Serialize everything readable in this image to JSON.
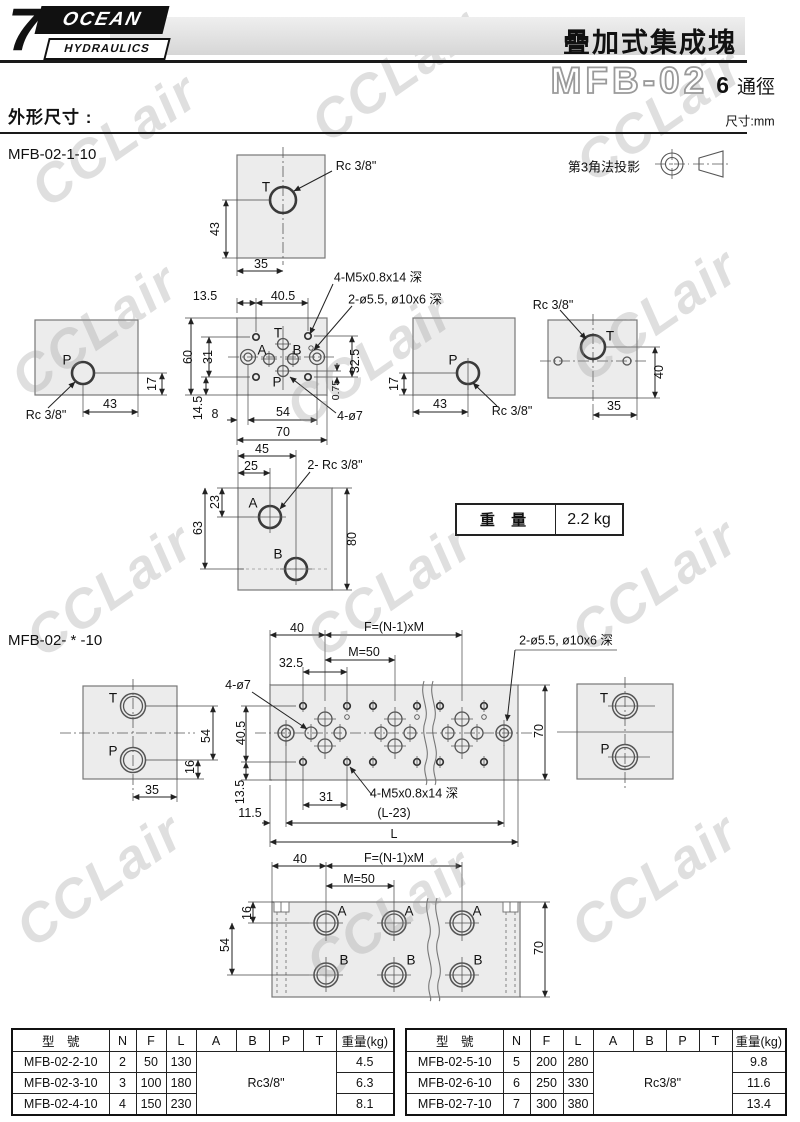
{
  "header": {
    "logo_7": "7",
    "logo_ocean": "OCEAN",
    "logo_hydraulics": "HYDRAULICS",
    "title": "疊加式集成塊",
    "model": "MFB-02",
    "bore_num": "6",
    "bore_suffix": "通徑",
    "section_heading": "外形尺寸 :",
    "unit": "尺寸:mm"
  },
  "watermark": "CCLair",
  "projection": {
    "label": "第3角法投影"
  },
  "weight": {
    "label": "重 量",
    "value": "2.2 kg"
  },
  "d1": {
    "label": "MFB-02-1-10",
    "t_top": "T",
    "rc38": "Rc 3/8\"",
    "d43": "43",
    "d35": "35",
    "m5_callout": "4-M5x0.8x14 深",
    "cb_callout": "2-ø5.5, ø10x6 深",
    "o7_callout": "4-ø7",
    "pT": "T",
    "pA": "A",
    "pB": "B",
    "pP": "P",
    "d13_5": "13.5",
    "d40_5": "40.5",
    "d60": "60",
    "d31": "31",
    "d32_5": "32.5",
    "d0_75": "0.75",
    "d14_5": "14.5",
    "d8": "8",
    "d54": "54",
    "d70": "70",
    "lv_p": "P",
    "lv_rc": "Rc 3/8\"",
    "lv_43": "43",
    "lv_17": "17",
    "rv_p": "P",
    "rv_rc": "Rc 3/8\"",
    "rv_43": "43",
    "rv_17": "17",
    "ev_t": "T",
    "ev_rc": "Rc 3/8\"",
    "ev_40": "40",
    "ev_35": "35",
    "bv_a": "A",
    "bv_b": "B",
    "bv_rc": "2- Rc 3/8\"",
    "bv_45": "45",
    "bv_25": "25",
    "bv_23": "23",
    "bv_63": "63",
    "bv_80": "80"
  },
  "d2": {
    "label": "MFB-02- * -10",
    "lv_t": "T",
    "lv_p": "P",
    "lv_54": "54",
    "lv_16": "16",
    "lv_35": "35",
    "o7_callout": "4-ø7",
    "cb_callout": "2-ø5.5, ø10x6 深",
    "m5_callout": "4-M5x0.8x14 深",
    "d40": "40",
    "f_formula": "F=(N-1)xM",
    "m50": "M=50",
    "d32_5": "32.5",
    "d40_5": "40.5",
    "d13_5": "13.5",
    "d11_5": "11.5",
    "d31": "31",
    "l23": "(L-23)",
    "l": "L",
    "d70": "70",
    "rv_t": "T",
    "rv_p": "P",
    "b40": "40",
    "b_f": "F=(N-1)xM",
    "b_m50": "M=50",
    "b16": "16",
    "b54": "54",
    "b70": "70",
    "pa": "A",
    "pb": "B"
  },
  "tables": {
    "left": {
      "headers": [
        "型　號",
        "N",
        "F",
        "L",
        "A",
        "B",
        "P",
        "T",
        "重量(kg)"
      ],
      "merged": "Rc3/8\"",
      "rows": [
        [
          "MFB-02-2-10",
          "2",
          "50",
          "130",
          "4.5"
        ],
        [
          "MFB-02-3-10",
          "3",
          "100",
          "180",
          "6.3"
        ],
        [
          "MFB-02-4-10",
          "4",
          "150",
          "230",
          "8.1"
        ]
      ]
    },
    "right": {
      "headers": [
        "型　號",
        "N",
        "F",
        "L",
        "A",
        "B",
        "P",
        "T",
        "重量(kg)"
      ],
      "merged": "Rc3/8\"",
      "rows": [
        [
          "MFB-02-5-10",
          "5",
          "200",
          "280",
          "9.8"
        ],
        [
          "MFB-02-6-10",
          "6",
          "250",
          "330",
          "11.6"
        ],
        [
          "MFB-02-7-10",
          "7",
          "300",
          "380",
          "13.4"
        ]
      ]
    }
  }
}
